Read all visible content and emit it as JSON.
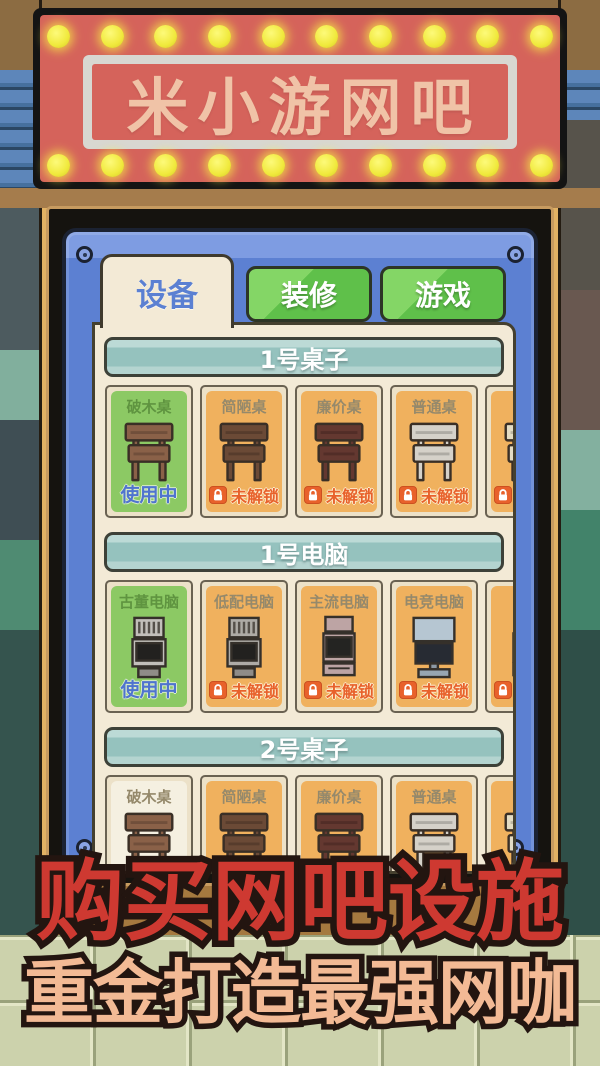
{
  "sign": {
    "title": "米小游网吧"
  },
  "panel": {
    "tabs": [
      {
        "label": "设备",
        "active": true
      },
      {
        "label": "装修",
        "active": false
      },
      {
        "label": "游戏",
        "active": false
      }
    ],
    "sections": [
      {
        "header": "1号桌子",
        "items": [
          {
            "name": "破木桌",
            "state": "in_use",
            "status": "使用中",
            "icon": "table",
            "icon_color": "#8a6148"
          },
          {
            "name": "简陋桌",
            "state": "locked",
            "status": "未解锁",
            "icon": "table",
            "icon_color": "#6b4a36"
          },
          {
            "name": "廉价桌",
            "state": "locked",
            "status": "未解锁",
            "icon": "table",
            "icon_color": "#643830"
          },
          {
            "name": "普通桌",
            "state": "locked",
            "status": "未解锁",
            "icon": "table",
            "icon_color": "#d5d1c9"
          },
          {
            "name": "奢",
            "state": "locked",
            "status": "未解锁",
            "icon": "table",
            "icon_color": "#e4dcc4"
          }
        ]
      },
      {
        "header": "1号电脑",
        "items": [
          {
            "name": "古董电脑",
            "state": "in_use",
            "status": "使用中",
            "icon": "pc-crt",
            "icon_color": "#c2bfba"
          },
          {
            "name": "低配电脑",
            "state": "locked",
            "status": "未解锁",
            "icon": "pc-crt",
            "icon_color": "#aeaba6"
          },
          {
            "name": "主流电脑",
            "state": "locked",
            "status": "未解锁",
            "icon": "pc-tower",
            "icon_color": "#bda4a4"
          },
          {
            "name": "电竞电脑",
            "state": "locked",
            "status": "未解锁",
            "icon": "pc-lcd",
            "icon_color": "#b6c6d2"
          },
          {
            "name": "曲",
            "state": "locked",
            "status": "未解锁",
            "icon": "pc-tower",
            "icon_color": "#cf9cb4"
          }
        ]
      },
      {
        "header": "2号桌子",
        "items": [
          {
            "name": "破木桌",
            "state": "available",
            "status": "",
            "icon": "table",
            "icon_color": "#8a6148"
          },
          {
            "name": "简陋桌",
            "state": "locked",
            "status": "未解锁",
            "icon": "table",
            "icon_color": "#6b4a36"
          },
          {
            "name": "廉价桌",
            "state": "locked",
            "status": "未解锁",
            "icon": "table",
            "icon_color": "#643830"
          },
          {
            "name": "普通桌",
            "state": "locked",
            "status": "未解锁",
            "icon": "table",
            "icon_color": "#d5d1c9"
          },
          {
            "name": "奢",
            "state": "locked",
            "status": "未解锁",
            "icon": "table",
            "icon_color": "#e4dcc4"
          }
        ]
      }
    ]
  },
  "promo": {
    "line1": "购买网吧设施",
    "line2": "重金打造最强网咖"
  },
  "colors": {
    "sign_red": "#d5635b",
    "sign_text": "#f0c3a7",
    "bulb_yellow": "#f0e93c",
    "panel_blue": "#5c80d2",
    "content_cream": "#f3ead6",
    "section_teal": "#95c2be",
    "card_in_use_green": "#8cc964",
    "card_locked_orange": "#f0b15e",
    "status_in_use_blue": "#4f74cf",
    "status_locked_red": "#e8612b",
    "tab_green": "#5fc04a",
    "promo_red": "#ce3931",
    "promo_peach": "#f3ba95"
  }
}
